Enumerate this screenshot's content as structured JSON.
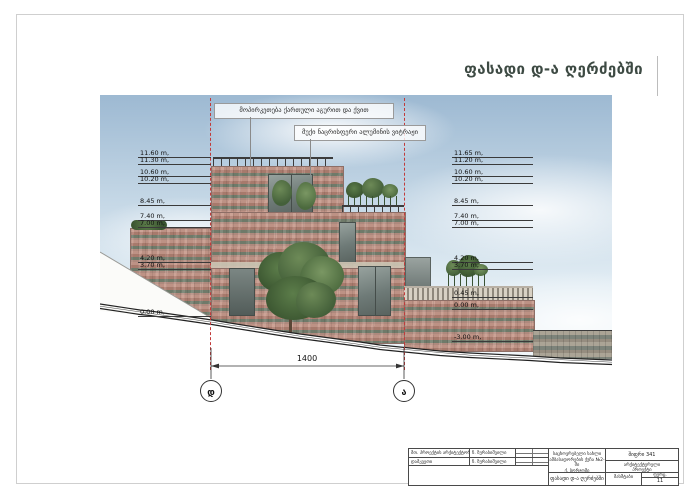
{
  "page": {
    "title": "ფასადი დ-ა ღერძებში"
  },
  "annotations": {
    "cladding": "მოპირკეთება ქართული აგურით და ქვით",
    "glazing": "მუქი ნაცრისფერი ალუმინის ვიტრაჟი"
  },
  "markers": {
    "left": [
      "11.60 m,",
      "11.30 m,",
      "10.60 m,",
      "10.20 m,",
      "8.45 m,",
      "7.40 m,",
      "7.00 m,",
      "4.20 m,",
      "3.70 m,",
      "0.00 m,"
    ],
    "right": [
      "11.65 m,",
      "11.20 m,",
      "10.60 m,",
      "10.20 m,",
      "8.45 m,",
      "7.40 m,",
      "7.00 m,",
      "4.20 m,",
      "3.70 m,",
      "0.45 m,",
      "0.00 m,",
      "-3.00 m,"
    ]
  },
  "dimension": {
    "value": "1400"
  },
  "grid": {
    "left": "დ",
    "right": "ა"
  },
  "titleblock": {
    "role1": "მთ. პროექტის არქიტექტორი",
    "name1": "ნ. ზურაბიშვილი",
    "role2": "დამკვეთი",
    "name2": "ნ. ზურაბიშვილი",
    "project1": "საცხოვრებელი სახლი",
    "project2": "ამბასადორების ქუჩა №2-ში",
    "project3": "ქ. ბორჯომი",
    "sheet_title": "ფასადი დ-ა ღერძებში",
    "code": "შიფრი 341",
    "org1": "არქიტექტურული",
    "org2": "პროექტი",
    "scale_label": "მასშტაბი",
    "sheet_label": "ფურც.",
    "sheet_number": "11"
  },
  "colors": {
    "axis_red": "#c23b3b",
    "sky_blue": "#c3d6e5",
    "brick": "#b4857b",
    "title_text": "#3d4a43"
  }
}
